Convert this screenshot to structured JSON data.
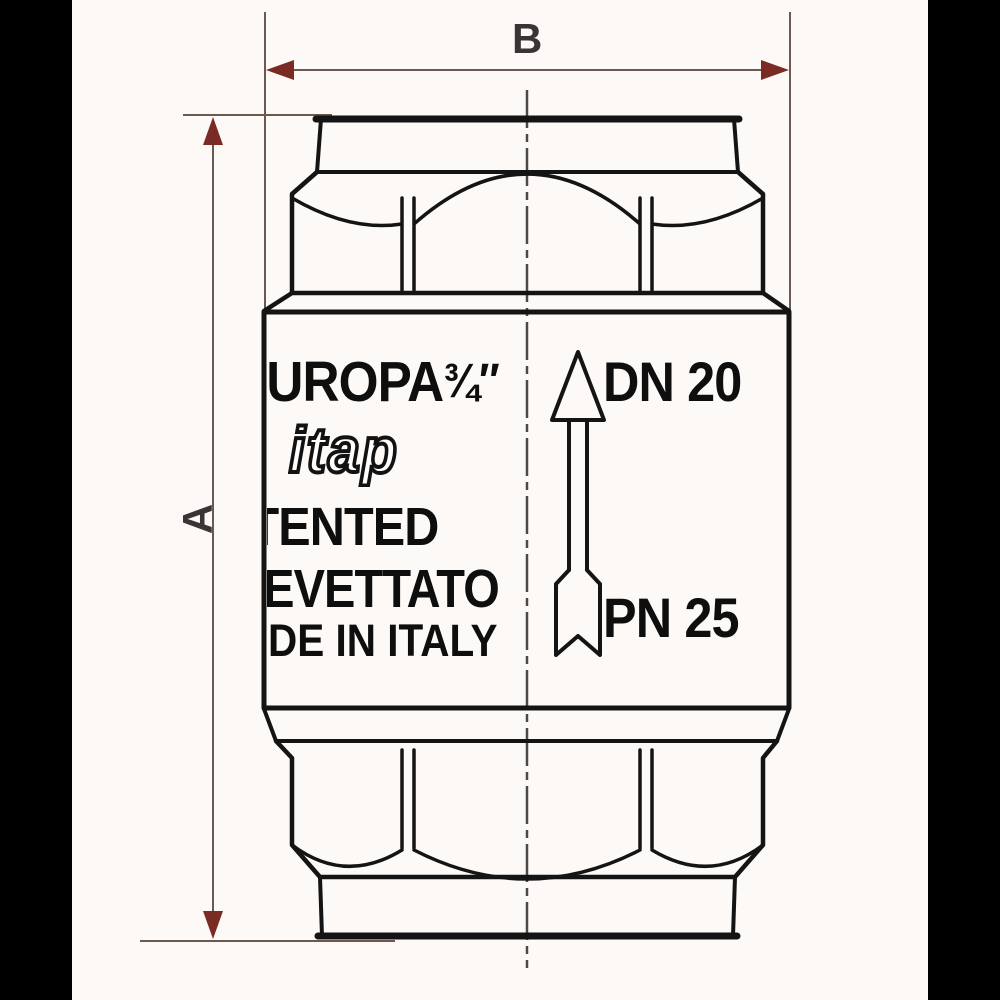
{
  "drawing": {
    "dimension_labels": {
      "height": "A",
      "width": "B"
    },
    "markings": {
      "brand": "EUROPA",
      "size": "¾″",
      "logo": "itap",
      "patented": "PATENTED",
      "brevettato": "BREVETTATO",
      "made_in": "MADE IN ITALY",
      "dn": "DN 20",
      "pn": "PN 25"
    },
    "flow_direction": "up"
  },
  "colors": {
    "background": "#fdf9f7",
    "letterbox": "#000000",
    "outline": "#141414",
    "dimension_line": "#6a5851",
    "dimension_arrow": "#7a2b24",
    "label_text": "#3b3434",
    "centerline": "#4a4a4a"
  }
}
